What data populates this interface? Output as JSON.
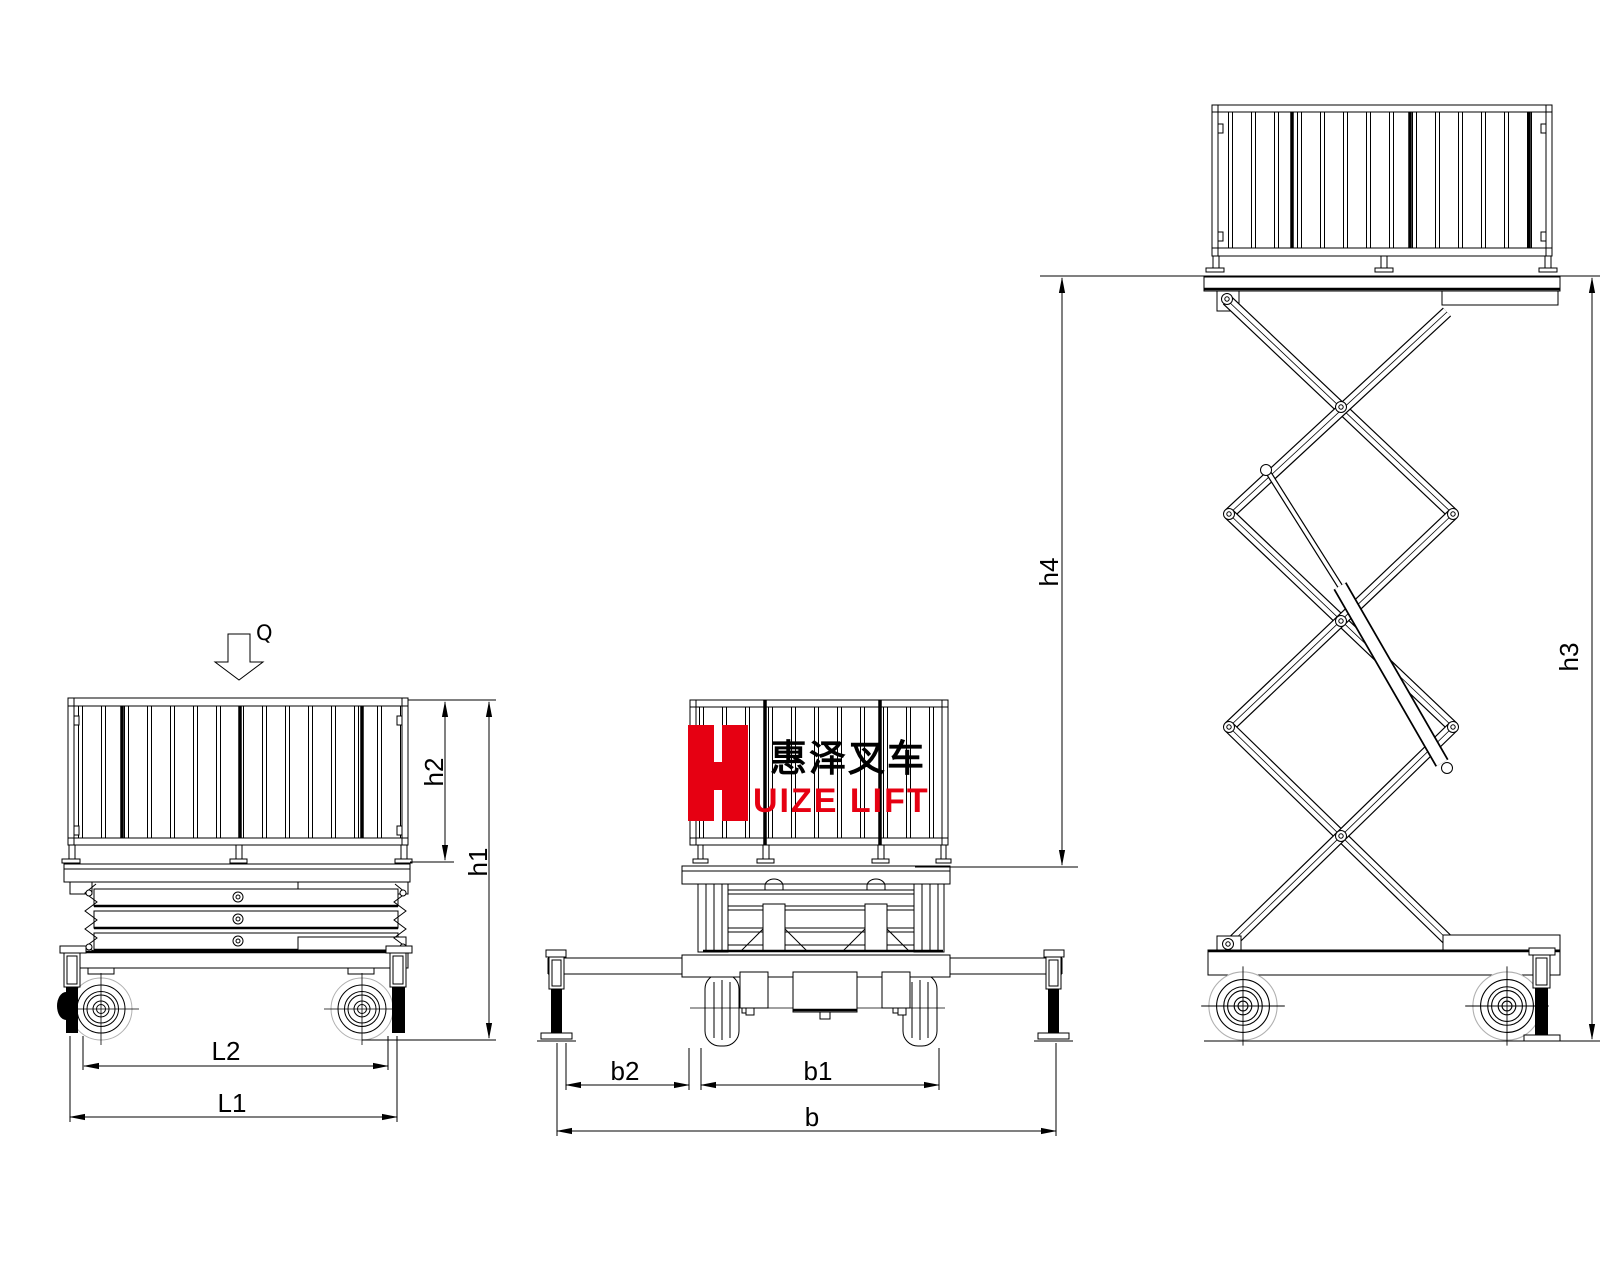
{
  "colors": {
    "background": "#ffffff",
    "ink": "#000000",
    "logo_red": "#e60012",
    "wheel_outline_gray": "#b0b0b0"
  },
  "logo": {
    "letter": "H",
    "chinese": "惠泽叉车",
    "latin": "UIZE LIFT"
  },
  "annotations": {
    "load_arrow": "Q",
    "left_view": {
      "h2": "h2",
      "h1": "h1",
      "L2": "L2",
      "L1": "L1"
    },
    "front_view": {
      "b2": "b2",
      "b1": "b1",
      "b": "b"
    },
    "raised_view": {
      "h4": "h4",
      "h3": "h3"
    }
  }
}
